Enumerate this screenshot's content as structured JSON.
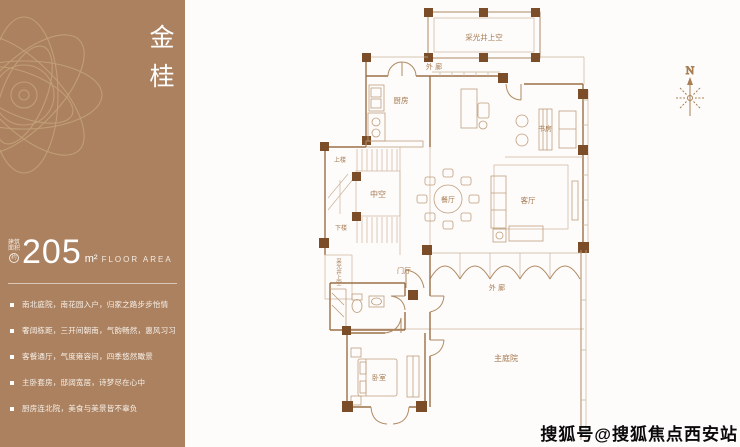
{
  "sidebar": {
    "title": "金桂",
    "area": {
      "prefix_line1": "建筑",
      "prefix_line2": "面积",
      "prefix_circle": "约",
      "value": "205",
      "unit": "m²",
      "unit_label": "FLOOR AREA"
    },
    "features": [
      "南北庭院，南花园入户，归家之路步步怡情",
      "奢阔栋距，三开间朝南，气韵畅然，惠风习习",
      "客餐通厅，气度雍容间，四季悠然瞰景",
      "主卧套房，邸阔宽居，诗梦尽在心中",
      "厨房连北院，美食与美景皆不辜负"
    ]
  },
  "plan": {
    "rooms": {
      "lightwell_top": "采光井上空",
      "corridor_top": "外 廊",
      "kitchen": "厨房",
      "dining": "餐厅",
      "living": "客厅",
      "study": "书房",
      "void": "中空",
      "stairs_up": "上楼",
      "stairs_down": "下楼",
      "foyer": "门厅",
      "bedroom": "卧室",
      "corridor_bottom": "外 廊",
      "courtyard": "主庭院",
      "lightwell_left": "采光井上空"
    },
    "compass_label": "N"
  },
  "watermark": "搜狐号@搜狐焦点西安站",
  "colors": {
    "sidebar_bg": "#ab8160",
    "plan_wall": "#9b6f47",
    "plan_light": "#ccb49a",
    "plan_post": "#7b4d28",
    "plan_label": "#a5794f",
    "watermark_text": "#0a0a0a"
  }
}
